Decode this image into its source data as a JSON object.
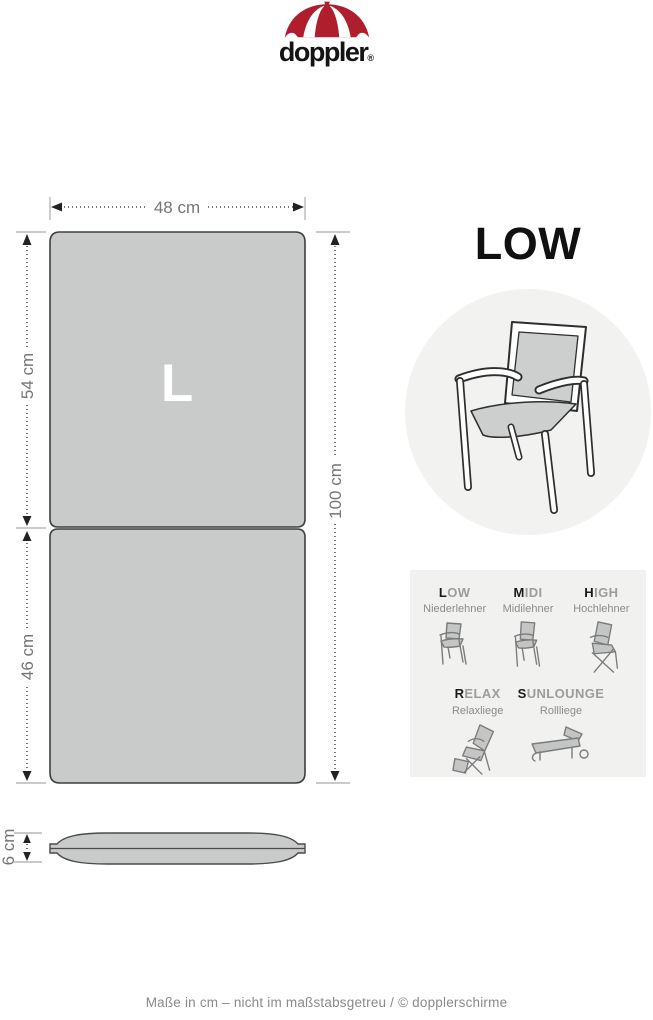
{
  "logo": {
    "brand": "doppler",
    "registered": "®"
  },
  "colors": {
    "brand_red": "#AE1E2C",
    "cushion_gray": "#C9CACA",
    "panel_gray": "#F2F2F1",
    "dimension_text_gray": "#757575"
  },
  "diagram": {
    "size_letter": "L",
    "width_label": "48 cm",
    "upper_section_label": "54 cm",
    "lower_section_label": "46 cm",
    "total_length_label": "100 cm",
    "thickness_label": "6 cm"
  },
  "product": {
    "type_title": "LOW"
  },
  "legend": {
    "items": [
      {
        "initial": "L",
        "rest": "OW",
        "sublabel": "Niederlehner"
      },
      {
        "initial": "M",
        "rest": "IDI",
        "sublabel": "Midilehner"
      },
      {
        "initial": "H",
        "rest": "IGH",
        "sublabel": "Hochlehner"
      },
      {
        "initial": "R",
        "rest": "ELAX",
        "sublabel": "Relaxliege"
      },
      {
        "initial": "S",
        "rest": "UNLOUNGE",
        "sublabel": "Rollliege"
      }
    ]
  },
  "footer": {
    "text": "Maße in cm – nicht im maßstabsgetreu / © dopplerschirme"
  }
}
